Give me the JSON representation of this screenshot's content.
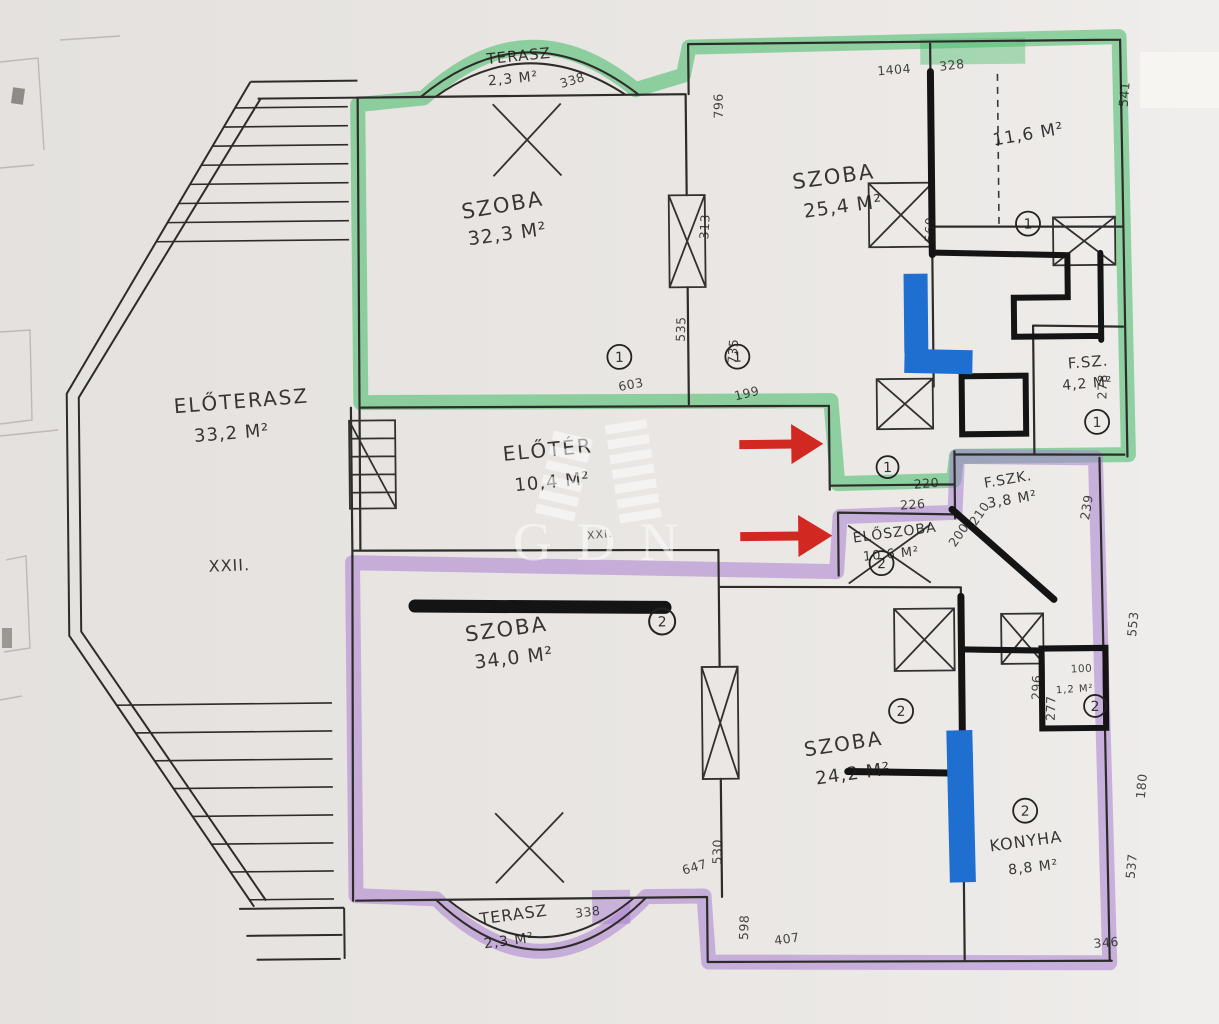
{
  "watermark": {
    "text": "GDN"
  },
  "unit_markers": {
    "one": "1",
    "two": "2"
  },
  "plot_labels": {
    "xxii": "XXII.",
    "xxi": "XXI."
  },
  "rooms": {
    "terasz_top": {
      "name": "TERASZ",
      "area": "2,3 M²"
    },
    "szoba_32": {
      "name": "SZOBA",
      "area": "32,3 M²"
    },
    "szoba_25": {
      "name": "SZOBA",
      "area": "25,4 M²"
    },
    "room_11_6": {
      "area": "11,6 M²"
    },
    "eloterasz": {
      "name": "ELŐTERASZ",
      "area": "33,2 M²"
    },
    "eloter": {
      "name": "ELŐTÉR",
      "area": "10,4 M²"
    },
    "fsz": {
      "name": "F.SZ.",
      "area": "4,2 M²"
    },
    "fszk": {
      "name": "F.SZK.",
      "area": "3,8 M²"
    },
    "eloszoba": {
      "name": "ELŐSZOBA",
      "area": "10,6 M²"
    },
    "szoba_34": {
      "name": "SZOBA",
      "area": "34,0 M²"
    },
    "szoba_24": {
      "name": "SZOBA",
      "area": "24,2 M²"
    },
    "konyha": {
      "name": "KONYHA",
      "area": "8,8 M²"
    },
    "kamra": {
      "area": "1,2 M²"
    },
    "terasz_bottom": {
      "name": "TERASZ",
      "area": "2,3 M²"
    }
  },
  "dims": [
    "796",
    "1404",
    "328",
    "541",
    "560",
    "313",
    "535",
    "735",
    "603",
    "199",
    "220",
    "226",
    "210",
    "200",
    "239",
    "278",
    "553",
    "296",
    "277",
    "100",
    "647",
    "530",
    "598",
    "407",
    "346",
    "537",
    "180",
    "338",
    "338"
  ],
  "colors": {
    "highlight_green": "#4fbe70",
    "highlight_purple": "#a97fd2",
    "arrow_red": "#d22822",
    "mark_blue": "#1e6fd0",
    "marker_black": "#141414",
    "wall_ink": "#2e2c2a",
    "paper": "#e8e5e2"
  }
}
